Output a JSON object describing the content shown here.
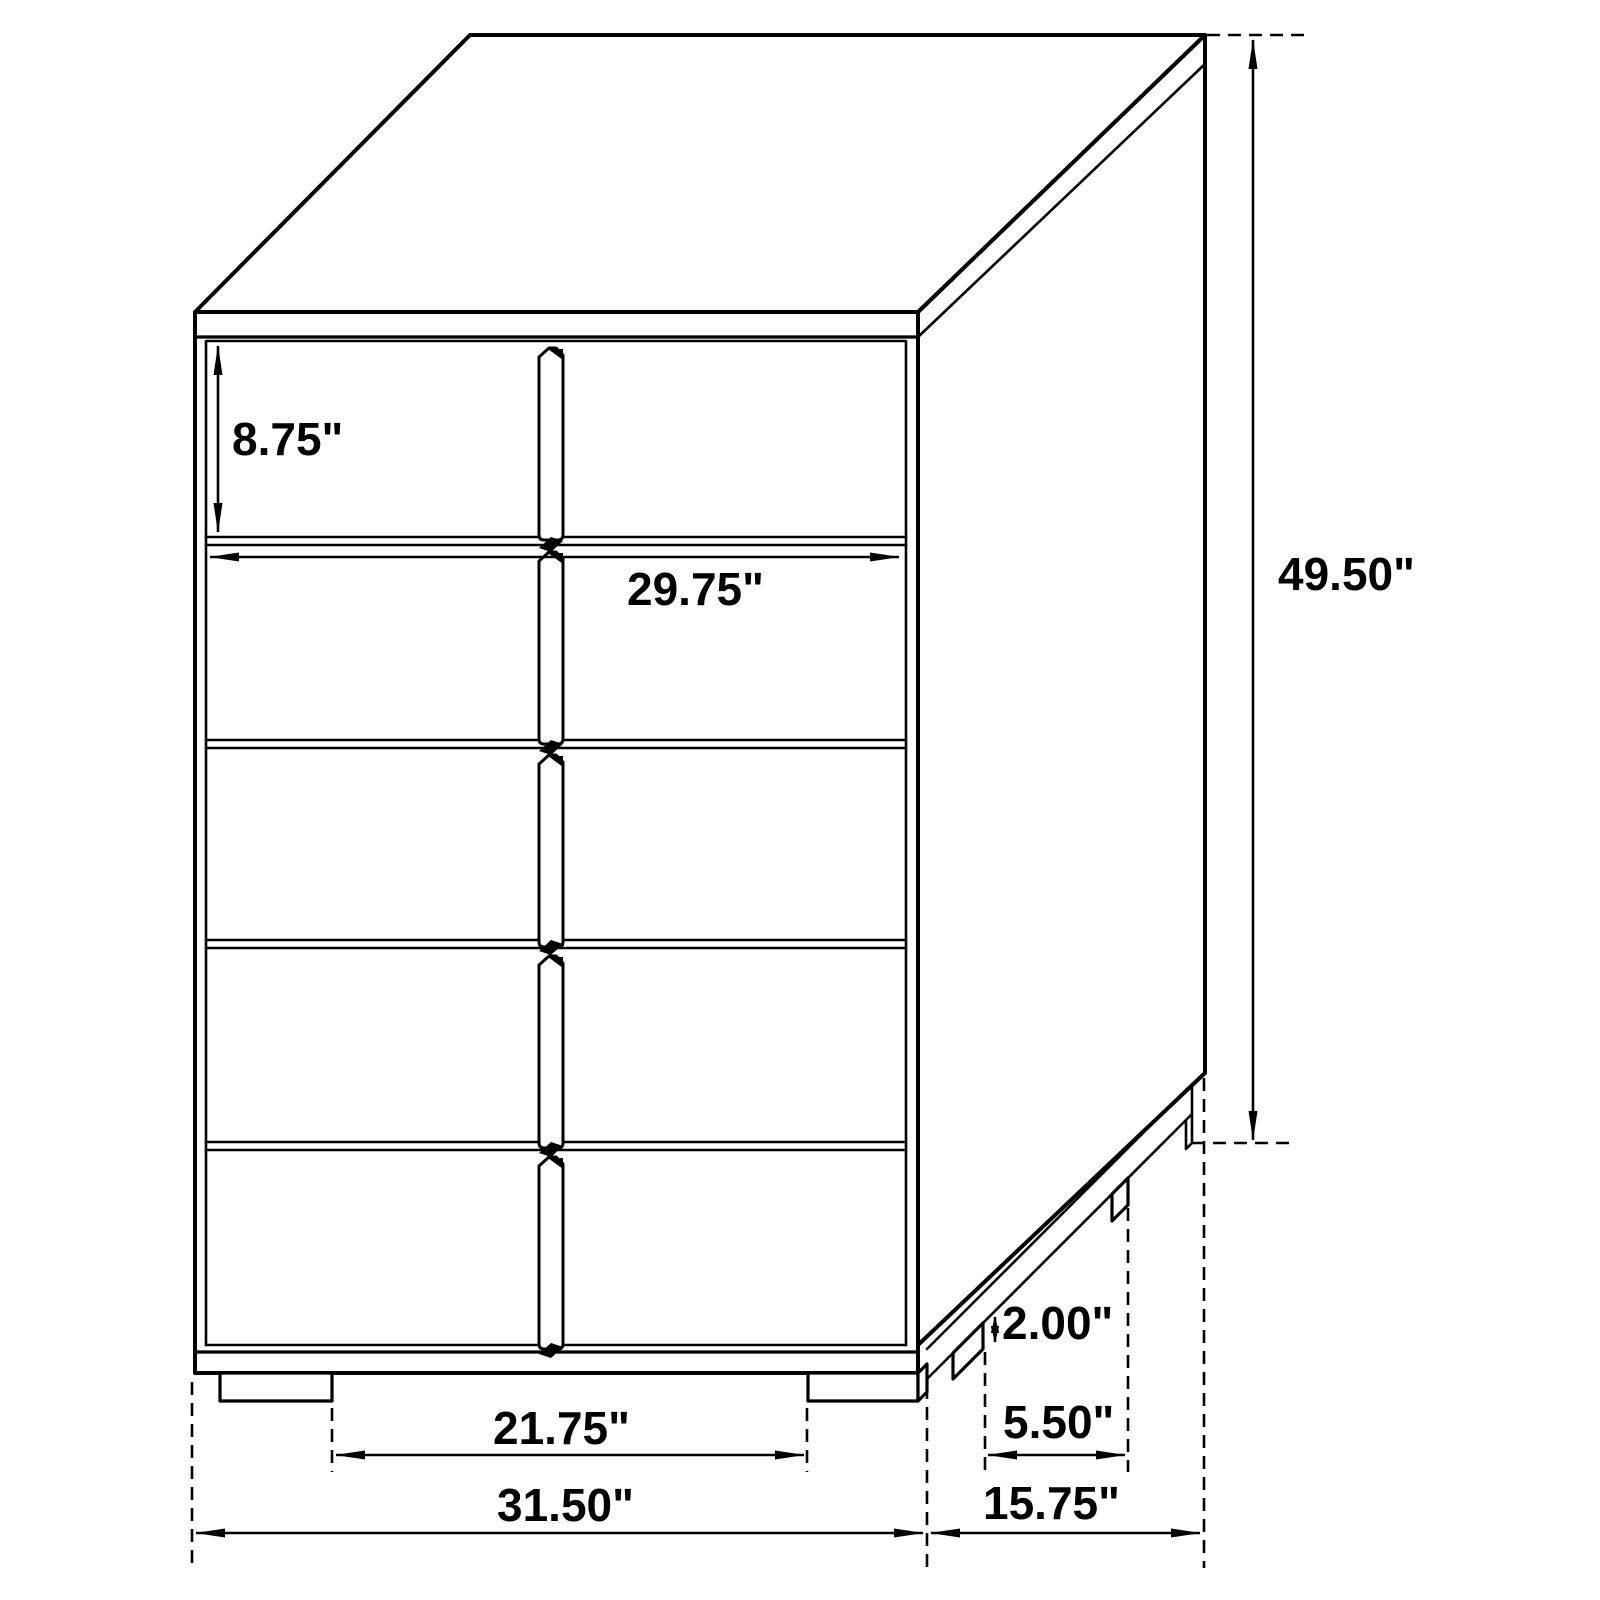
{
  "colors": {
    "line": "#000000",
    "background": "#ffffff",
    "text": "#000000"
  },
  "diagram": {
    "type": "furniture-dimension-drawing",
    "item": "five-drawer chest",
    "drawer_count": 5,
    "unit": "inches"
  },
  "dimensions": {
    "drawer_height": {
      "value": 8.75,
      "unit": "in",
      "label": "8.75\""
    },
    "drawer_width": {
      "value": 29.75,
      "unit": "in",
      "label": "29.75\""
    },
    "overall_height": {
      "value": 49.5,
      "unit": "in",
      "label": "49.50\""
    },
    "leg_height": {
      "value": 2.0,
      "unit": "in",
      "label": "2.00\""
    },
    "side_leg_spacing": {
      "value": 5.5,
      "unit": "in",
      "label": "5.50\""
    },
    "front_leg_spacing": {
      "value": 21.75,
      "unit": "in",
      "label": "21.75\""
    },
    "overall_width": {
      "value": 31.5,
      "unit": "in",
      "label": "31.50\""
    },
    "overall_depth": {
      "value": 15.75,
      "unit": "in",
      "label": "15.75\""
    }
  }
}
